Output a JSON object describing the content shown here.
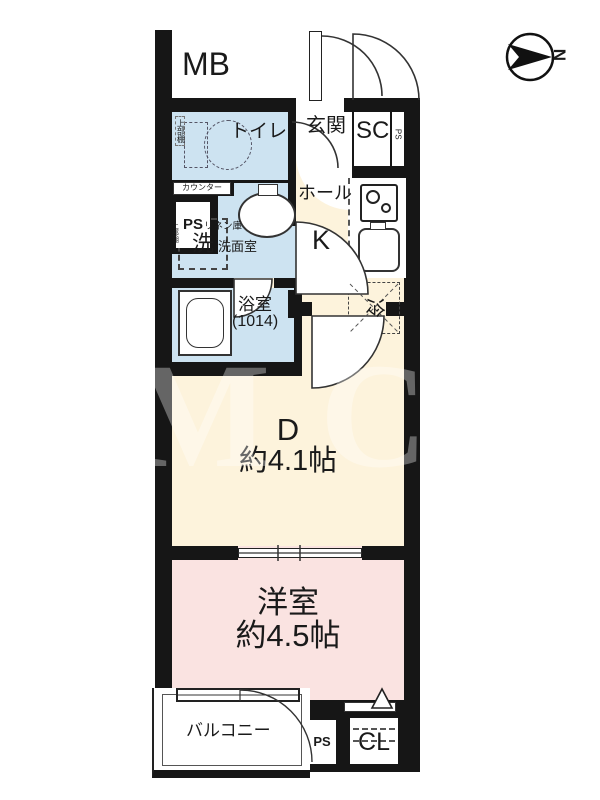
{
  "colors": {
    "wall": "#161616",
    "line": "#333333",
    "cream": "#fdf3dc",
    "pink": "#fae3e1",
    "blue": "#cde3f1"
  },
  "compass": {
    "north_label": "N"
  },
  "watermark": {
    "text": "OM CO"
  },
  "labels": {
    "mb": "MB",
    "toilet": "トイレ",
    "toilet_shelf": "上部棚",
    "counter": "カウンター",
    "ps_upper": "PS",
    "genkan": "玄関",
    "shoe_closet": "SC",
    "ps_side": "PS",
    "hall": "ホール",
    "kitchen": "K",
    "washer": "洗",
    "washer_shelf": "上部棚",
    "linen": "リネン庫",
    "washroom": "洗面室",
    "bathroom": "浴室",
    "bathroom_size": "(1014)",
    "fridge": "冷",
    "dining": "D",
    "dining_size": "約4.1帖",
    "western_room": "洋室",
    "western_room_size": "約4.5帖",
    "balcony": "バルコニー",
    "ps_bottom": "PS",
    "closet": "CL"
  }
}
